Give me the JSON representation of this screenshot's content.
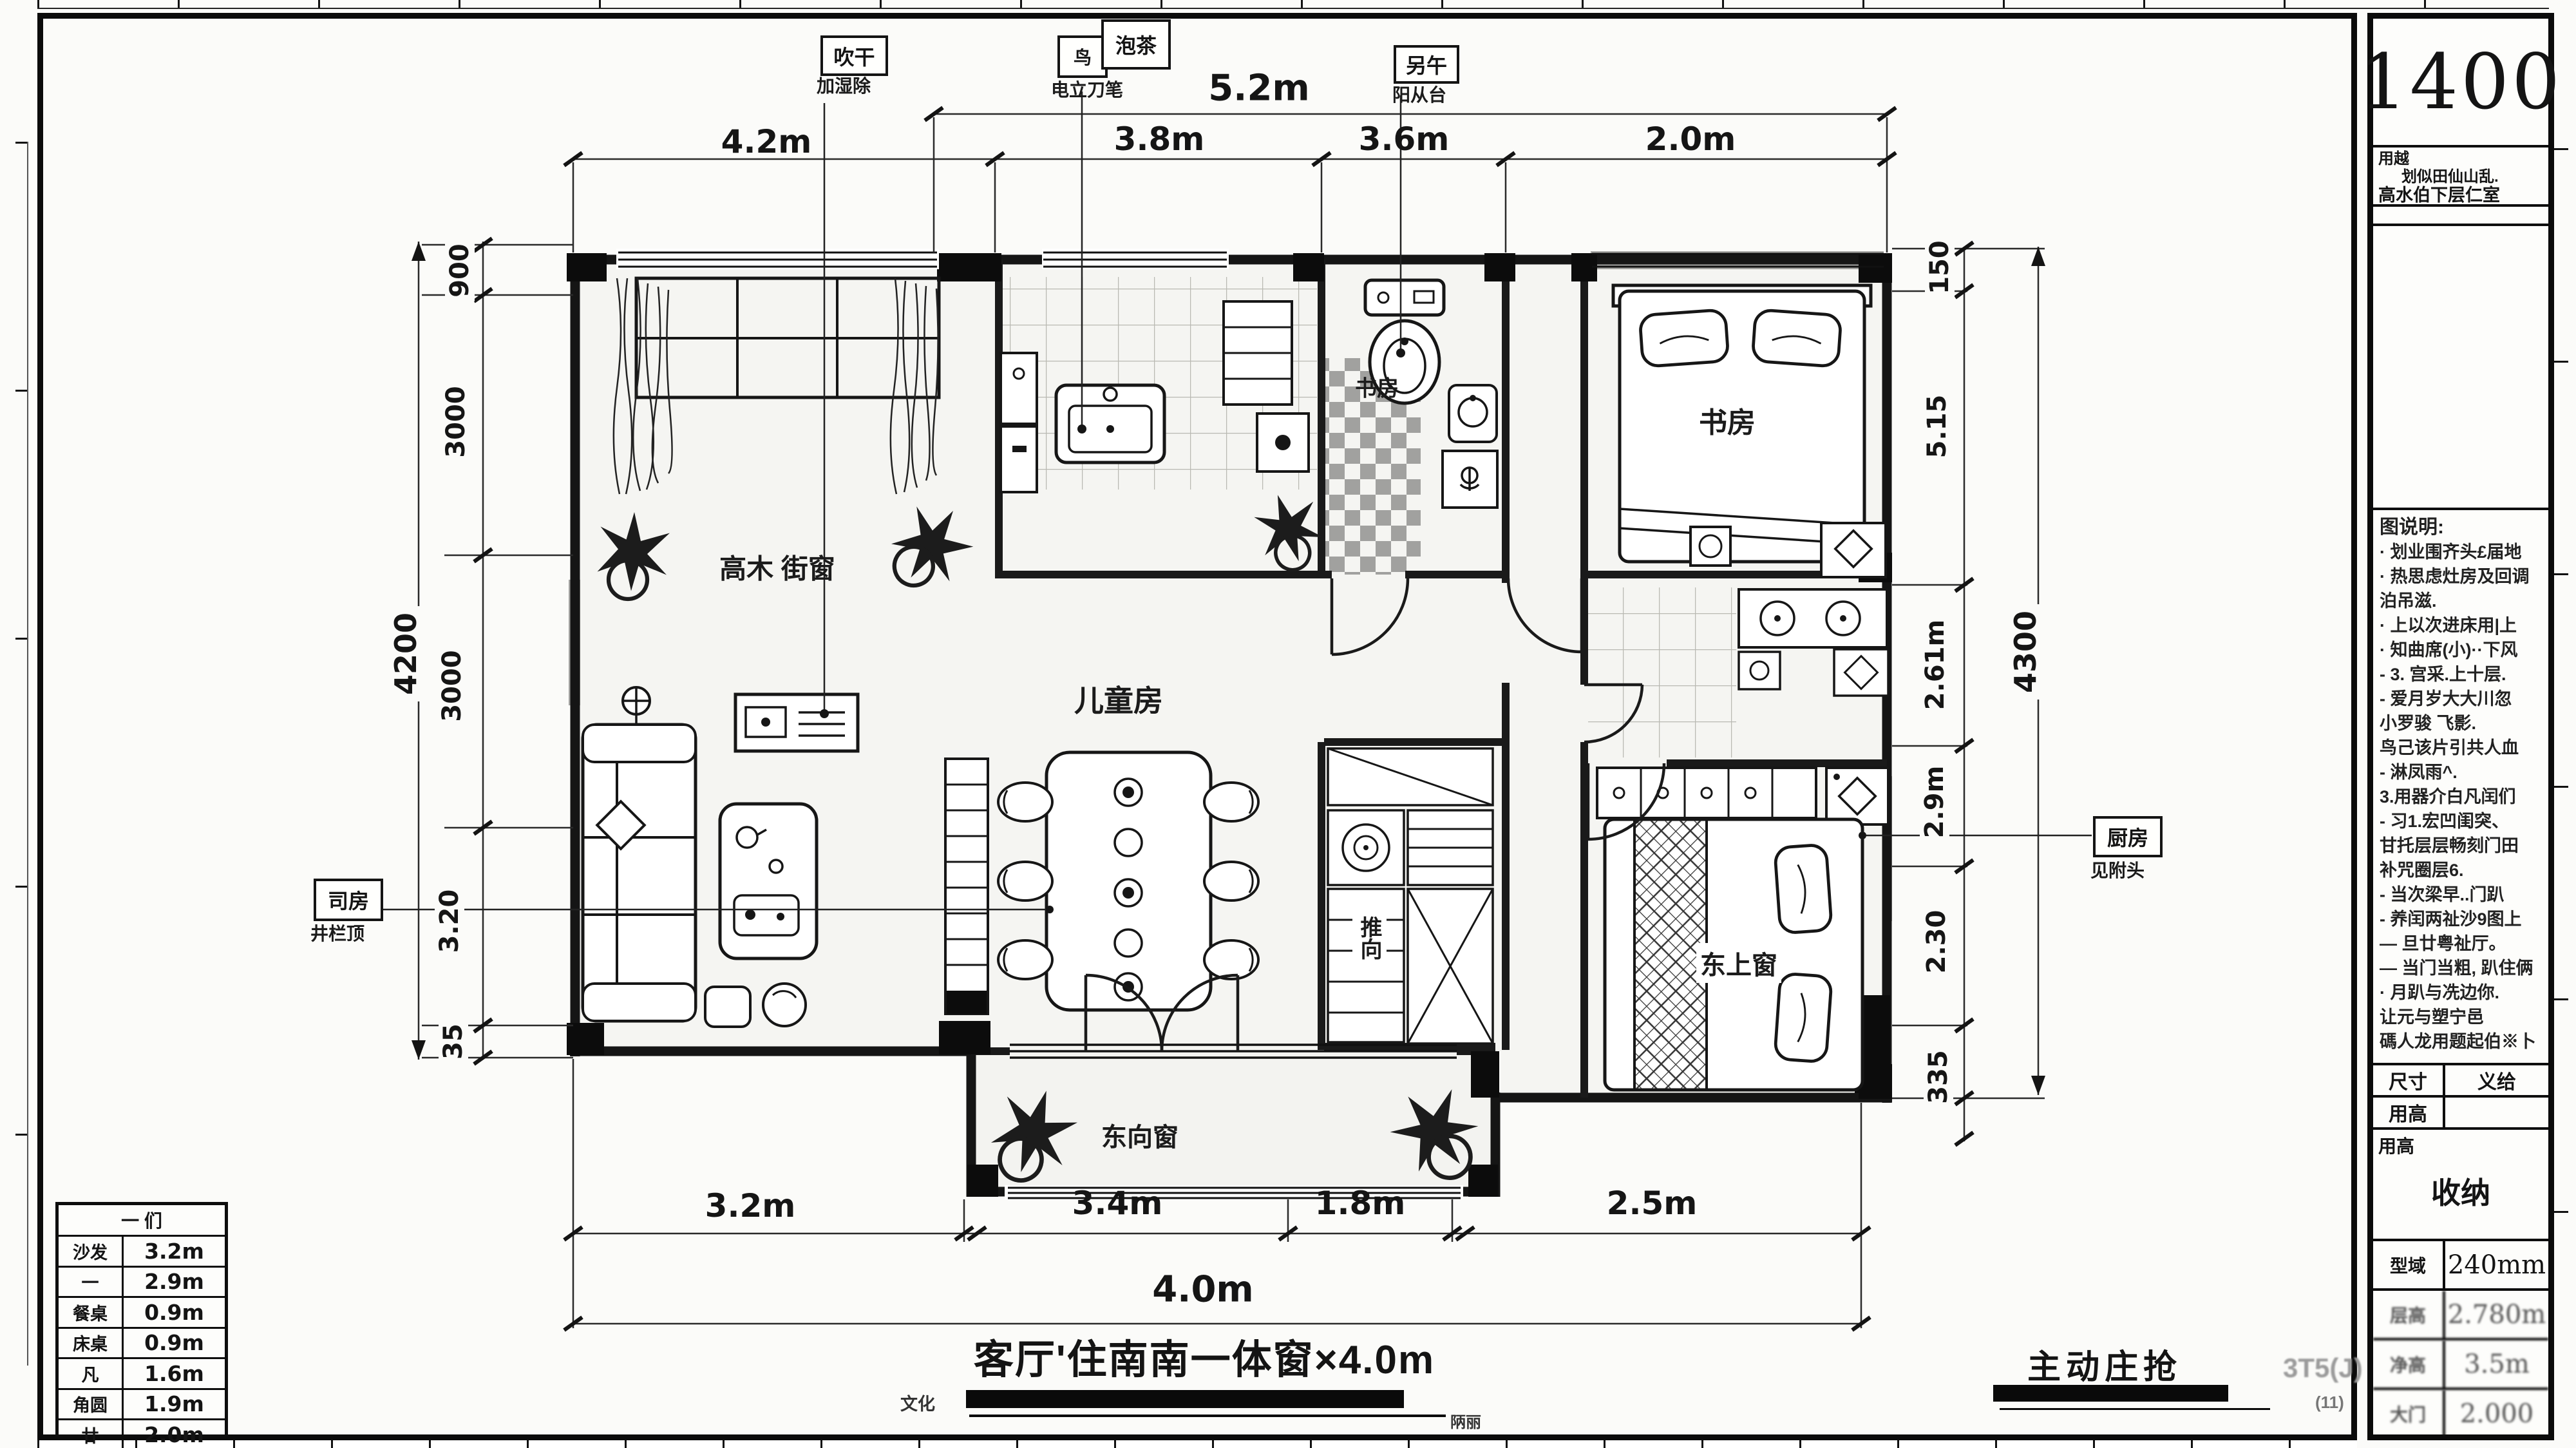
{
  "page": {
    "bg": "#fbfbf9",
    "ink": "#141414",
    "wall_gray": "#a5a5a3",
    "floor": "#f5f5f2"
  },
  "title_block": {
    "scale_big": "1400",
    "project": {
      "label": "用越",
      "line1": "划似田仙山乱.",
      "line2": "高水伯下层仁室"
    },
    "notes": {
      "header": "图说明:",
      "lines": [
        "· 划业围齐头£届地",
        "· 热思虑灶房及回调",
        "  泊吊滋.",
        "· 上以次进床用|上",
        "· 知曲席(小)··下风",
        "- 3. 宫采.上十层.",
        "- 爱月岁大大川忽",
        "  小罗骏 飞影.",
        "  鸟己该片引共人血",
        "- 淋凤雨^.",
        "  3.用器介白凡闰们",
        "- 习1.宏凹闺突、",
        "  甘托层层畅刻门田",
        "  补咒圈层6.",
        "- 当次梁早..门趴",
        "- 养闰两祉沙9图上",
        "— 旦廿粤祉厅。",
        "— 当门当粗, 趴住俩",
        "· 月趴与冼边你.",
        "  让元与塑宁邑",
        "碼人龙用题起伯※卜"
      ]
    },
    "fields": [
      {
        "label": "尺寸",
        "value": "义给"
      },
      {
        "label": "用高",
        "value": ""
      }
    ],
    "summary": {
      "corner_label": "用高",
      "center": "收纳"
    },
    "specs": [
      {
        "label": "型域",
        "value": "240mm"
      },
      {
        "label": "层高",
        "value": "2.780m"
      },
      {
        "label": "净高",
        "value": "3.5m"
      },
      {
        "label": "大门",
        "value": "2.000"
      }
    ]
  },
  "dims": {
    "top_overall": "5.2m",
    "top_segments": [
      "4.2m",
      "3.8m",
      "3.6m",
      "2.0m"
    ],
    "bottom_segments": [
      "3.2m",
      "3.4m",
      "1.8m",
      "2.5m"
    ],
    "bottom_overall": "4.0m",
    "left_overall": "4200",
    "left_segments": [
      "900",
      "3000",
      "3000",
      "3.20",
      "35"
    ],
    "right_overall": "4300",
    "right_segments": [
      "150",
      "5.15",
      "2.61m",
      "2.9m",
      "2.30",
      "335"
    ]
  },
  "callouts": {
    "blow": {
      "box": "吹干",
      "caption": "加湿除"
    },
    "tea": {
      "box_small": "鸟",
      "box": "泡茶",
      "caption": "电立刀笔"
    },
    "noon": {
      "box": "另午",
      "caption": "阳从台"
    },
    "left": {
      "box": "司房",
      "caption": "井栏顶"
    },
    "right": {
      "box": "厨房",
      "caption": "见附头"
    }
  },
  "rooms": {
    "living": "高木 街窗",
    "children": "儿童房",
    "bath_label": "书房",
    "bedroom_top": "书房",
    "master": "东上窗",
    "balcony": "东向窗",
    "closet": "推向"
  },
  "legend": {
    "header": "一  们",
    "rows": [
      [
        "沙发",
        "3.2m"
      ],
      [
        "一",
        "2.9m"
      ],
      [
        "餐桌",
        "0.9m"
      ],
      [
        "床桌",
        "0.9m"
      ],
      [
        "凡",
        "1.6m"
      ],
      [
        "角圆",
        "1.9m"
      ],
      [
        "廿",
        "2.0m"
      ]
    ]
  },
  "footer": {
    "title": "客厅'住南南一体窗×4.0m",
    "bar_left": "文化",
    "bar_right": "陃丽",
    "stamp": "主动庄抢",
    "watermark": "3T5(J)",
    "watermark2": "(11)"
  }
}
